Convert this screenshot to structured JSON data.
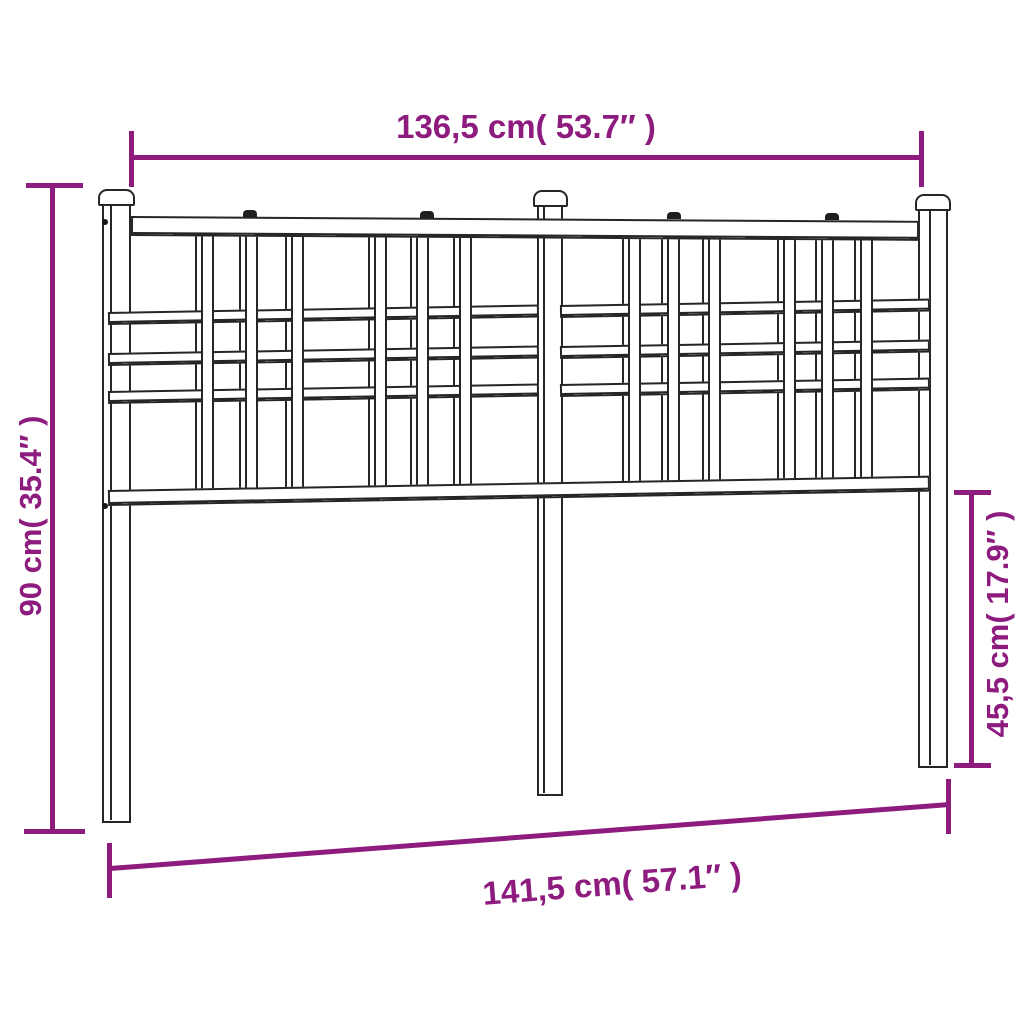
{
  "diagram": {
    "title": "metal headboard dimension drawing",
    "accent_color": "#8e1b7e",
    "outline_color": "#262626",
    "dimensions": {
      "top": {
        "label": "136,5 cm( 53.7″ )"
      },
      "left": {
        "label": "90 cm( 35.4″ )"
      },
      "right": {
        "label": "45,5 cm( 17.9″ )"
      },
      "bottom": {
        "label": "141,5 cm( 57.1″ )"
      }
    }
  }
}
